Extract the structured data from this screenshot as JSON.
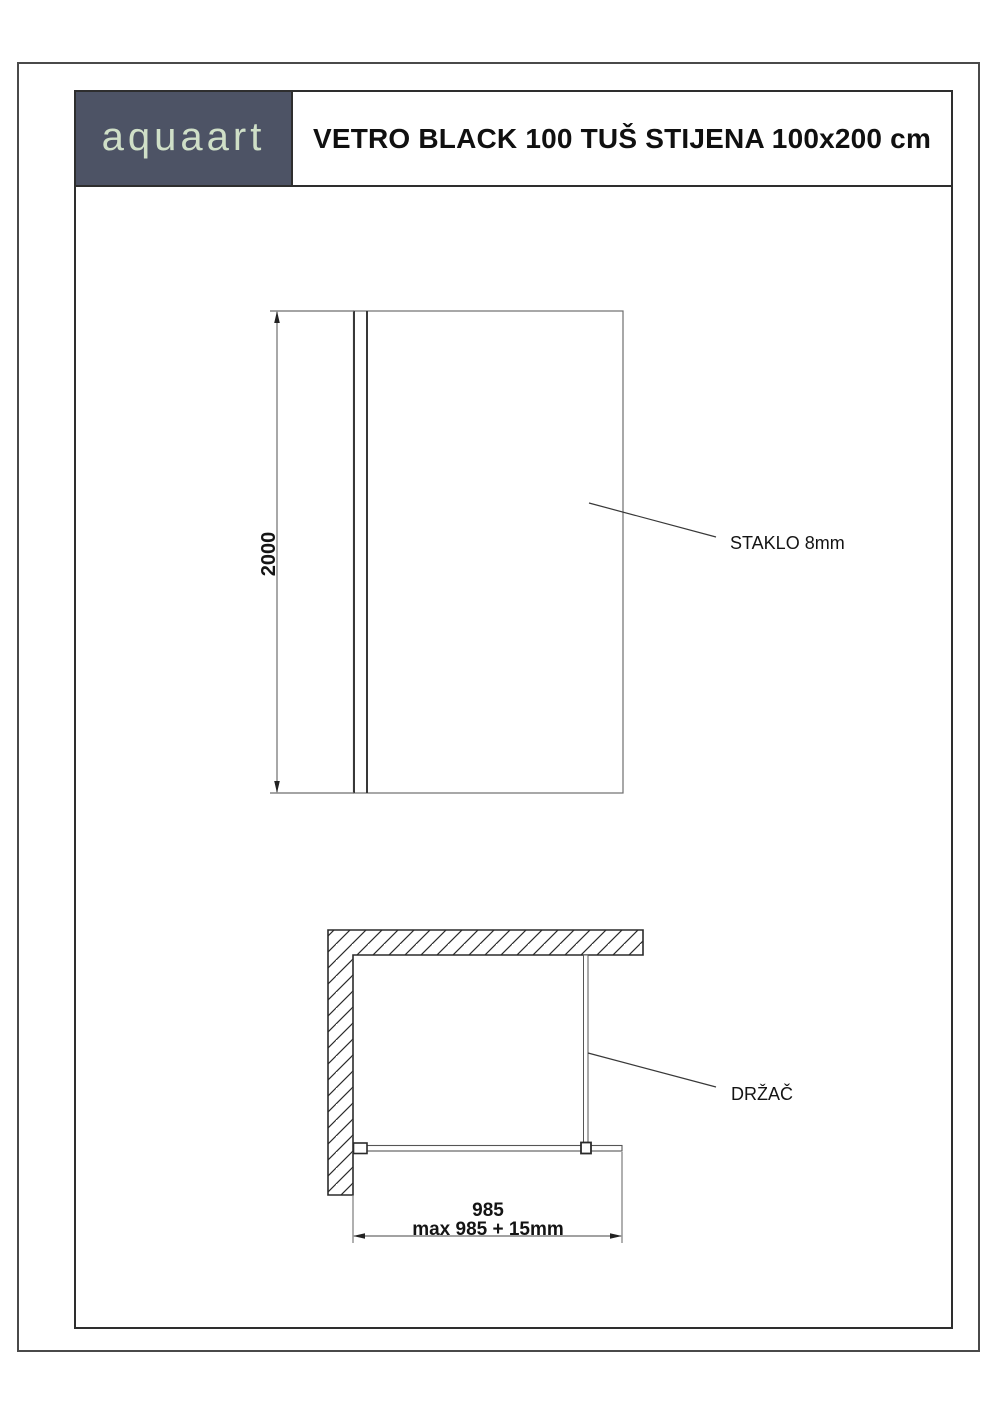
{
  "header": {
    "logo": "aquaart",
    "title": "VETRO BLACK 100 TUŠ STIJENA 100x200 cm"
  },
  "front_view": {
    "height_dimension": "2000",
    "glass_label": "STAKLO 8mm"
  },
  "plan_view": {
    "holder_label": "DRŽAČ",
    "width_dimension": "985",
    "width_dimension_max": "max 985 + 15mm"
  },
  "colors": {
    "logo_background": "#4d5365",
    "logo_text": "#cfdfc7",
    "frame_line": "#2e2e2e",
    "thin_line": "#6e6e6e"
  }
}
